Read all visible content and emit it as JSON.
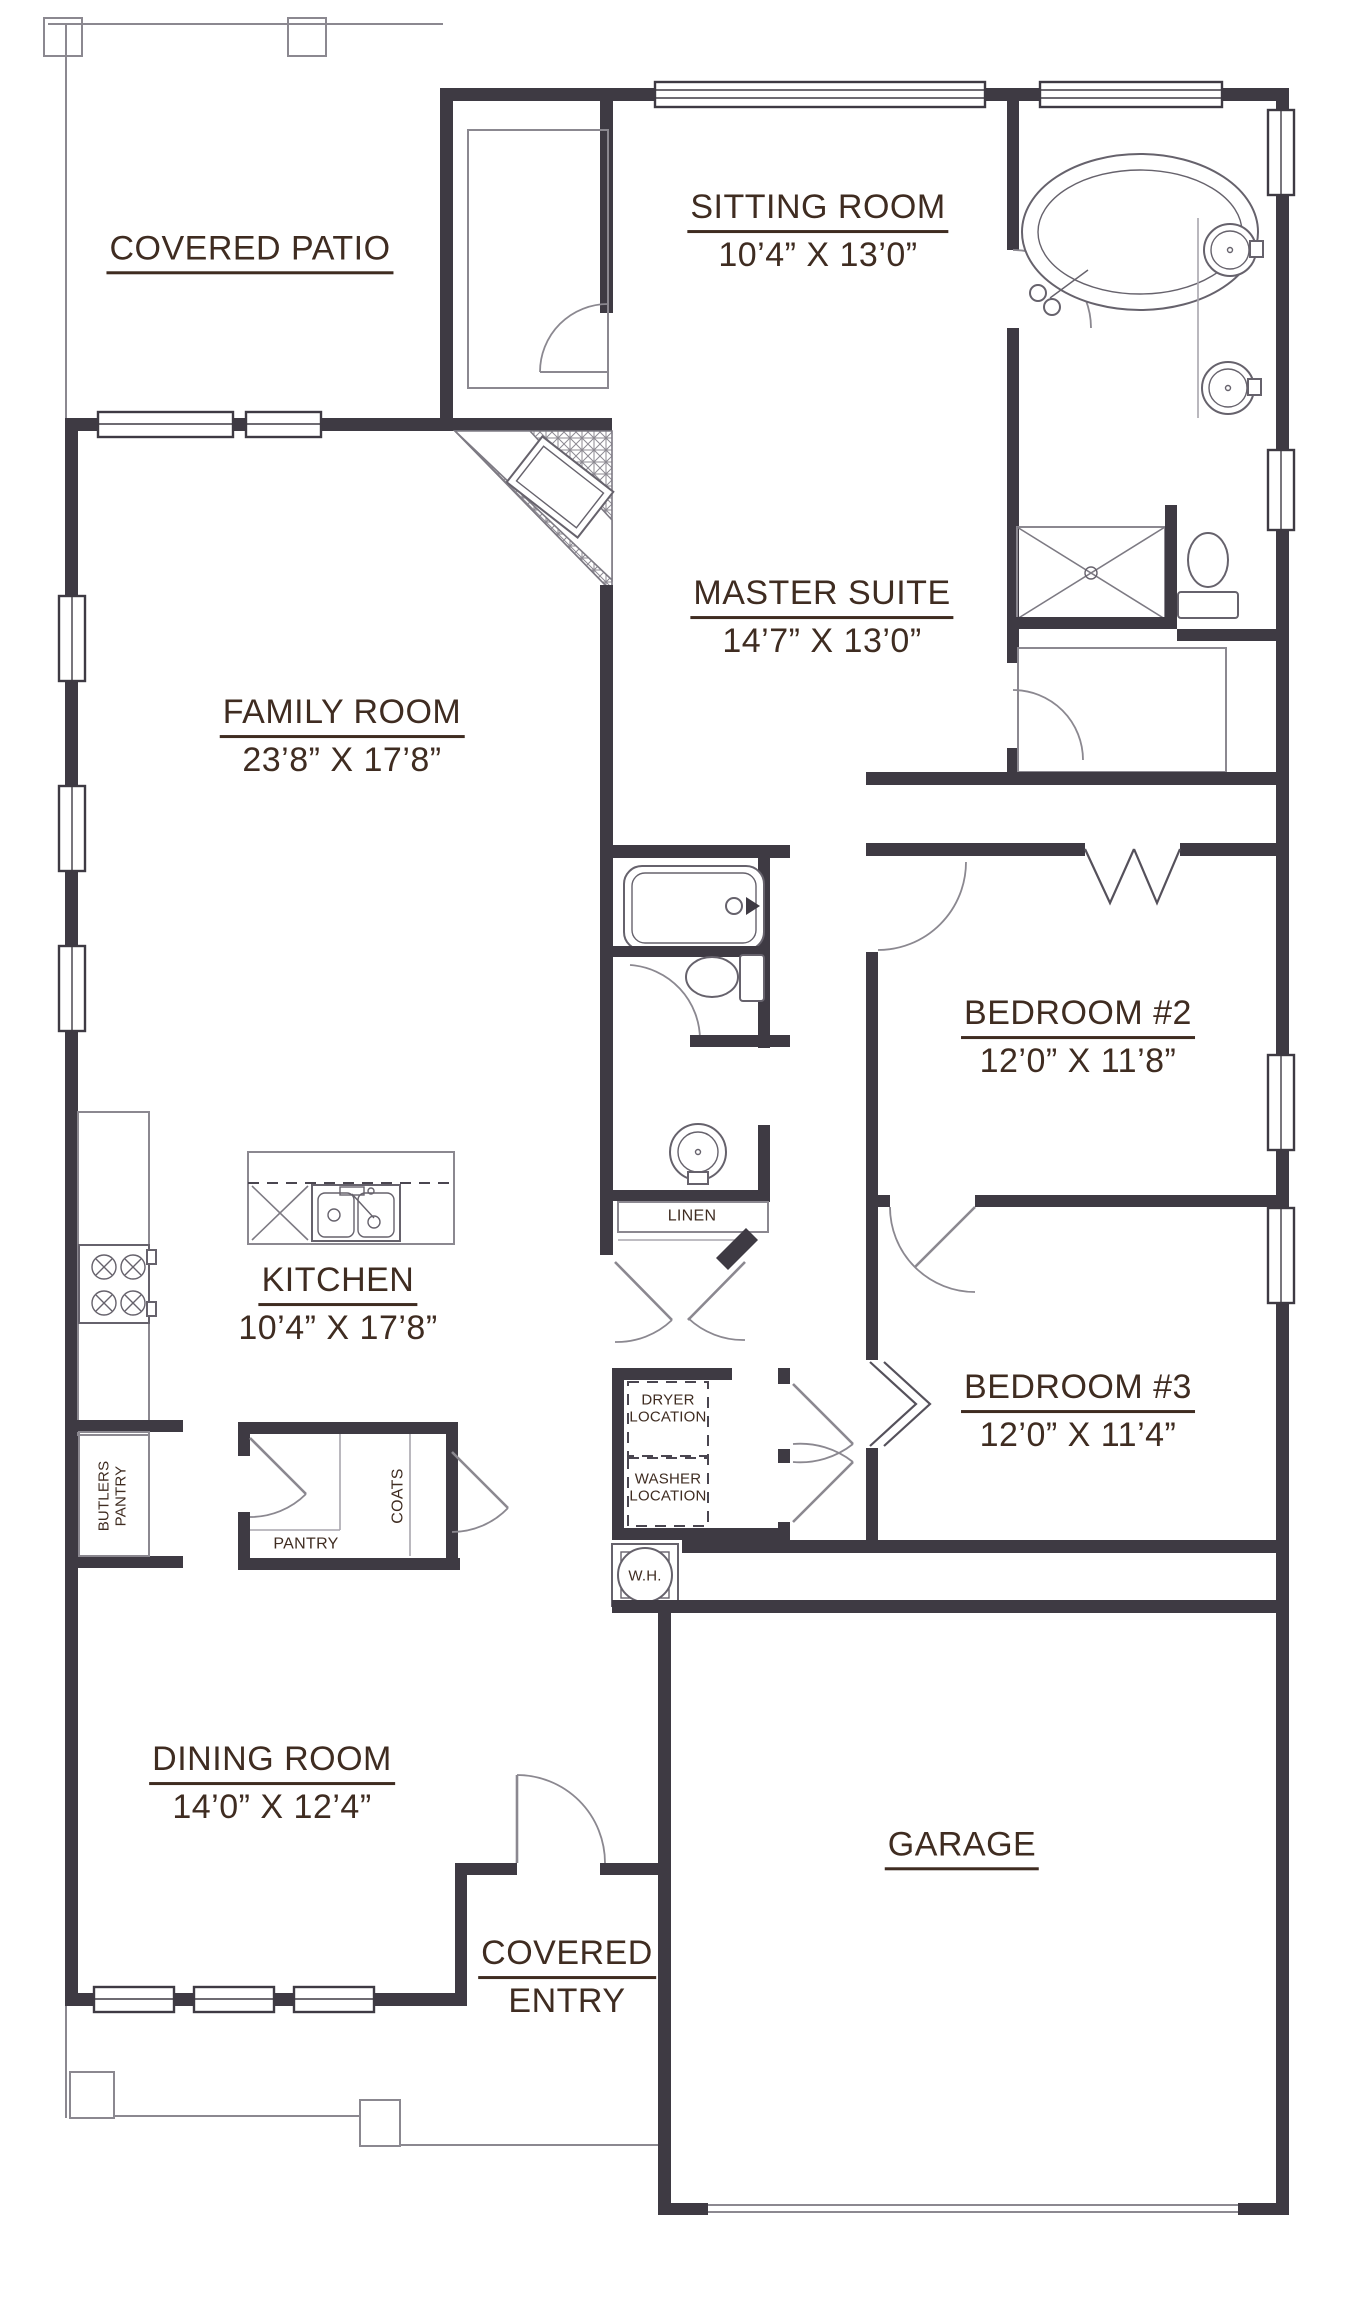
{
  "plan": {
    "rooms": {
      "covered_patio": {
        "name": "COVERED PATIO"
      },
      "sitting_room": {
        "name": "SITTING ROOM",
        "dims": "10’4” X 13’0”"
      },
      "master_suite": {
        "name": "MASTER SUITE",
        "dims": "14’7” X 13’0”"
      },
      "family_room": {
        "name": "FAMILY ROOM",
        "dims": "23’8” X 17’8”"
      },
      "bedroom_2": {
        "name": "BEDROOM #2",
        "dims": "12’0” X 11’8”"
      },
      "bedroom_3": {
        "name": "BEDROOM #3",
        "dims": "12’0” X 11’4”"
      },
      "kitchen": {
        "name": "KITCHEN",
        "dims": "10’4” X 17’8”"
      },
      "dining_room": {
        "name": "DINING ROOM",
        "dims": "14’0” X 12’4”"
      },
      "garage": {
        "name": "GARAGE"
      },
      "covered_entry": {
        "line1": "COVERED",
        "line2": "ENTRY"
      }
    },
    "closets": {
      "linen": "LINEN",
      "pantry": "PANTRY",
      "coats": "COATS",
      "butlers_pantry_line1": "BUTLERS",
      "butlers_pantry_line2": "PANTRY"
    },
    "appliances": {
      "dryer_line1": "DRYER",
      "dryer_line2": "LOCATION",
      "washer_line1": "WASHER",
      "washer_line2": "LOCATION",
      "water_heater": "W.H."
    },
    "colors": {
      "wall": "#3e3a43",
      "text": "#3f2c21",
      "thin_line": "#8b8890"
    }
  }
}
